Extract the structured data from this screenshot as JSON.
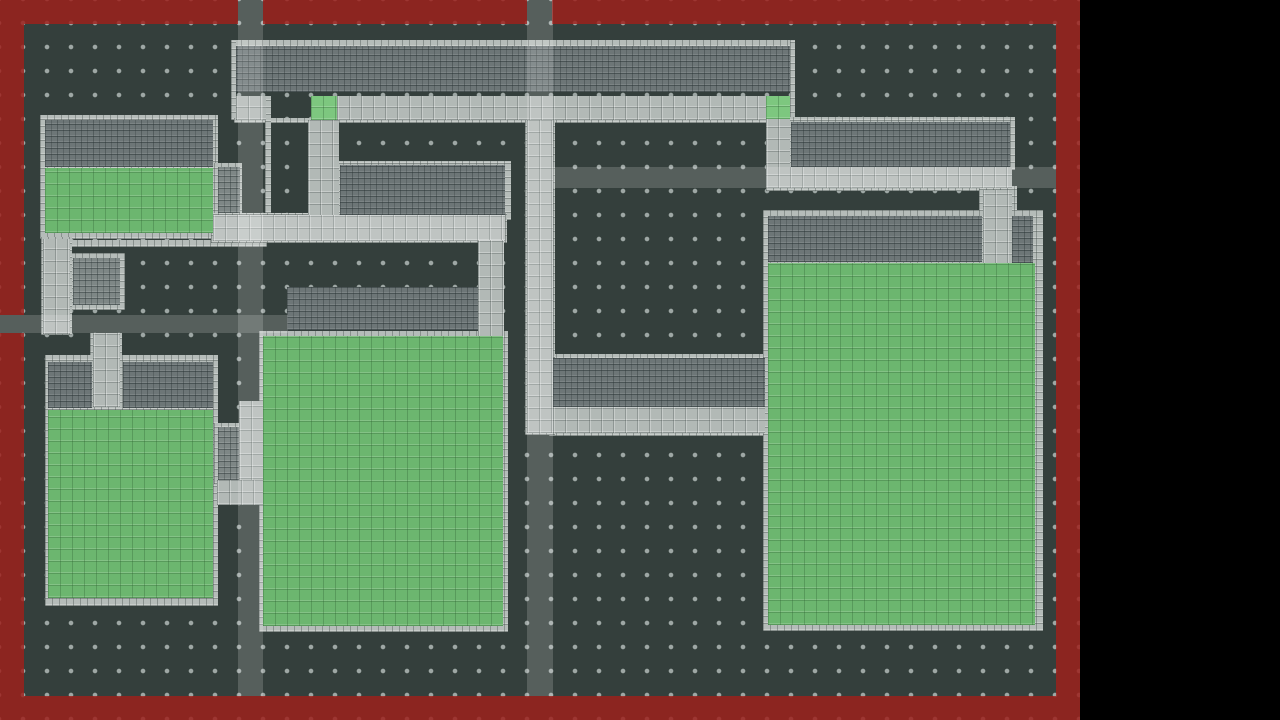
{
  "scene": {
    "page_width": 1280,
    "page_height": 720,
    "map_width": 1080,
    "map_height": 720,
    "outside_color": "#000000"
  },
  "map": {
    "floor_color": "#343f3c",
    "dot_color": "rgba(176,186,183,0.85)",
    "dot_spacing": 24,
    "dot_offset": 11,
    "dot_radius": 2
  },
  "palette": {
    "sidewalk_frame": "#b5bcb9",
    "sidewalk_path": "#b2b9b6",
    "building_wall": "#6d7677",
    "inner_brick": "#7e8786",
    "grass": "#6cb66f",
    "grass_accent": "#7dc77f",
    "boundary_red": "rgba(157,32,28,0.84)",
    "road_overlay": "rgba(255,255,255,0.17)"
  },
  "render_order": [
    "frames",
    "medium_bricks",
    "dark_bricks",
    "light_paths",
    "greens",
    "green_accents",
    "red_border",
    "road_overlays"
  ],
  "layer_styles": {
    "frames": {
      "class": "frame",
      "name": "sidewalk-frame-tile"
    },
    "medium_bricks": {
      "class": "medium",
      "name": "inner-courtyard-brick"
    },
    "dark_bricks": {
      "class": "wall",
      "name": "building-wall-bricks"
    },
    "light_paths": {
      "class": "path",
      "name": "sidewalk-path"
    },
    "greens": {
      "class": "grass",
      "name": "grass-field"
    },
    "green_accents": {
      "class": "grass-accent",
      "name": "grass-entry-tile"
    },
    "red_border": {
      "class": "redwall",
      "name": "map-boundary-wall"
    },
    "road_overlays": {
      "class": "overlay",
      "name": "road-overlay-band"
    }
  },
  "layers": {
    "frames": [
      [
        234,
        40,
        560,
        7
      ],
      [
        231,
        40,
        5,
        80
      ],
      [
        790,
        40,
        5,
        80
      ],
      [
        234,
        118,
        560,
        5
      ],
      [
        265,
        96,
        6,
        124
      ],
      [
        336,
        161,
        175,
        59
      ],
      [
        40,
        115,
        178,
        124
      ],
      [
        214,
        163,
        28,
        55
      ],
      [
        70,
        240,
        197,
        7
      ],
      [
        68,
        253,
        57,
        57
      ],
      [
        41,
        237,
        31,
        98
      ],
      [
        90,
        333,
        32,
        76
      ],
      [
        45,
        355,
        173,
        251
      ],
      [
        214,
        423,
        30,
        61
      ],
      [
        259,
        331,
        249,
        301
      ],
      [
        549,
        354,
        222,
        82
      ],
      [
        786,
        117,
        229,
        53
      ],
      [
        763,
        210,
        280,
        421
      ],
      [
        525,
        118,
        30,
        317
      ],
      [
        766,
        165,
        244,
        26
      ],
      [
        211,
        213,
        296,
        30
      ],
      [
        979,
        186,
        38,
        81
      ]
    ],
    "medium_bricks": [
      [
        218,
        167,
        22,
        46
      ],
      [
        73,
        258,
        47,
        47
      ],
      [
        218,
        427,
        22,
        53
      ]
    ],
    "dark_bricks": [
      [
        236,
        46,
        554,
        46
      ],
      [
        45,
        120,
        168,
        47
      ],
      [
        340,
        165,
        165,
        50
      ],
      [
        553,
        358,
        212,
        49
      ],
      [
        791,
        122,
        219,
        45
      ],
      [
        768,
        216,
        214,
        46
      ],
      [
        1012,
        216,
        21,
        47
      ],
      [
        287,
        287,
        191,
        43
      ],
      [
        48,
        362,
        44,
        46
      ],
      [
        123,
        362,
        90,
        46
      ]
    ],
    "light_paths": [
      [
        236,
        96,
        30,
        24
      ],
      [
        337,
        96,
        453,
        24
      ],
      [
        308,
        120,
        31,
        97
      ],
      [
        213,
        215,
        292,
        26
      ],
      [
        478,
        240,
        26,
        98
      ],
      [
        527,
        120,
        26,
        313
      ],
      [
        43,
        239,
        27,
        95
      ],
      [
        93,
        333,
        27,
        74
      ],
      [
        239,
        401,
        25,
        102
      ],
      [
        217,
        480,
        46,
        25
      ],
      [
        553,
        407,
        212,
        26
      ],
      [
        766,
        167,
        246,
        21
      ],
      [
        766,
        118,
        24,
        70
      ],
      [
        983,
        190,
        29,
        77
      ]
    ],
    "greens": [
      [
        45,
        168,
        168,
        65
      ],
      [
        48,
        410,
        165,
        188
      ],
      [
        263,
        336,
        240,
        290
      ],
      [
        768,
        263,
        267,
        362
      ]
    ],
    "green_accents": [
      [
        311,
        96,
        26,
        24
      ],
      [
        766,
        96,
        24,
        23
      ]
    ],
    "red_border": [
      [
        0,
        0,
        238,
        24
      ],
      [
        263,
        0,
        264,
        24
      ],
      [
        552,
        0,
        528,
        24
      ],
      [
        0,
        696,
        1080,
        24
      ],
      [
        0,
        24,
        24,
        291
      ],
      [
        0,
        333,
        24,
        363
      ],
      [
        1056,
        24,
        24,
        672
      ]
    ],
    "road_overlays": [
      [
        238,
        0,
        25,
        696
      ],
      [
        527,
        0,
        26,
        696
      ],
      [
        553,
        167,
        503,
        21
      ],
      [
        0,
        315,
        288,
        18
      ],
      [
        213,
        215,
        292,
        26
      ]
    ]
  }
}
